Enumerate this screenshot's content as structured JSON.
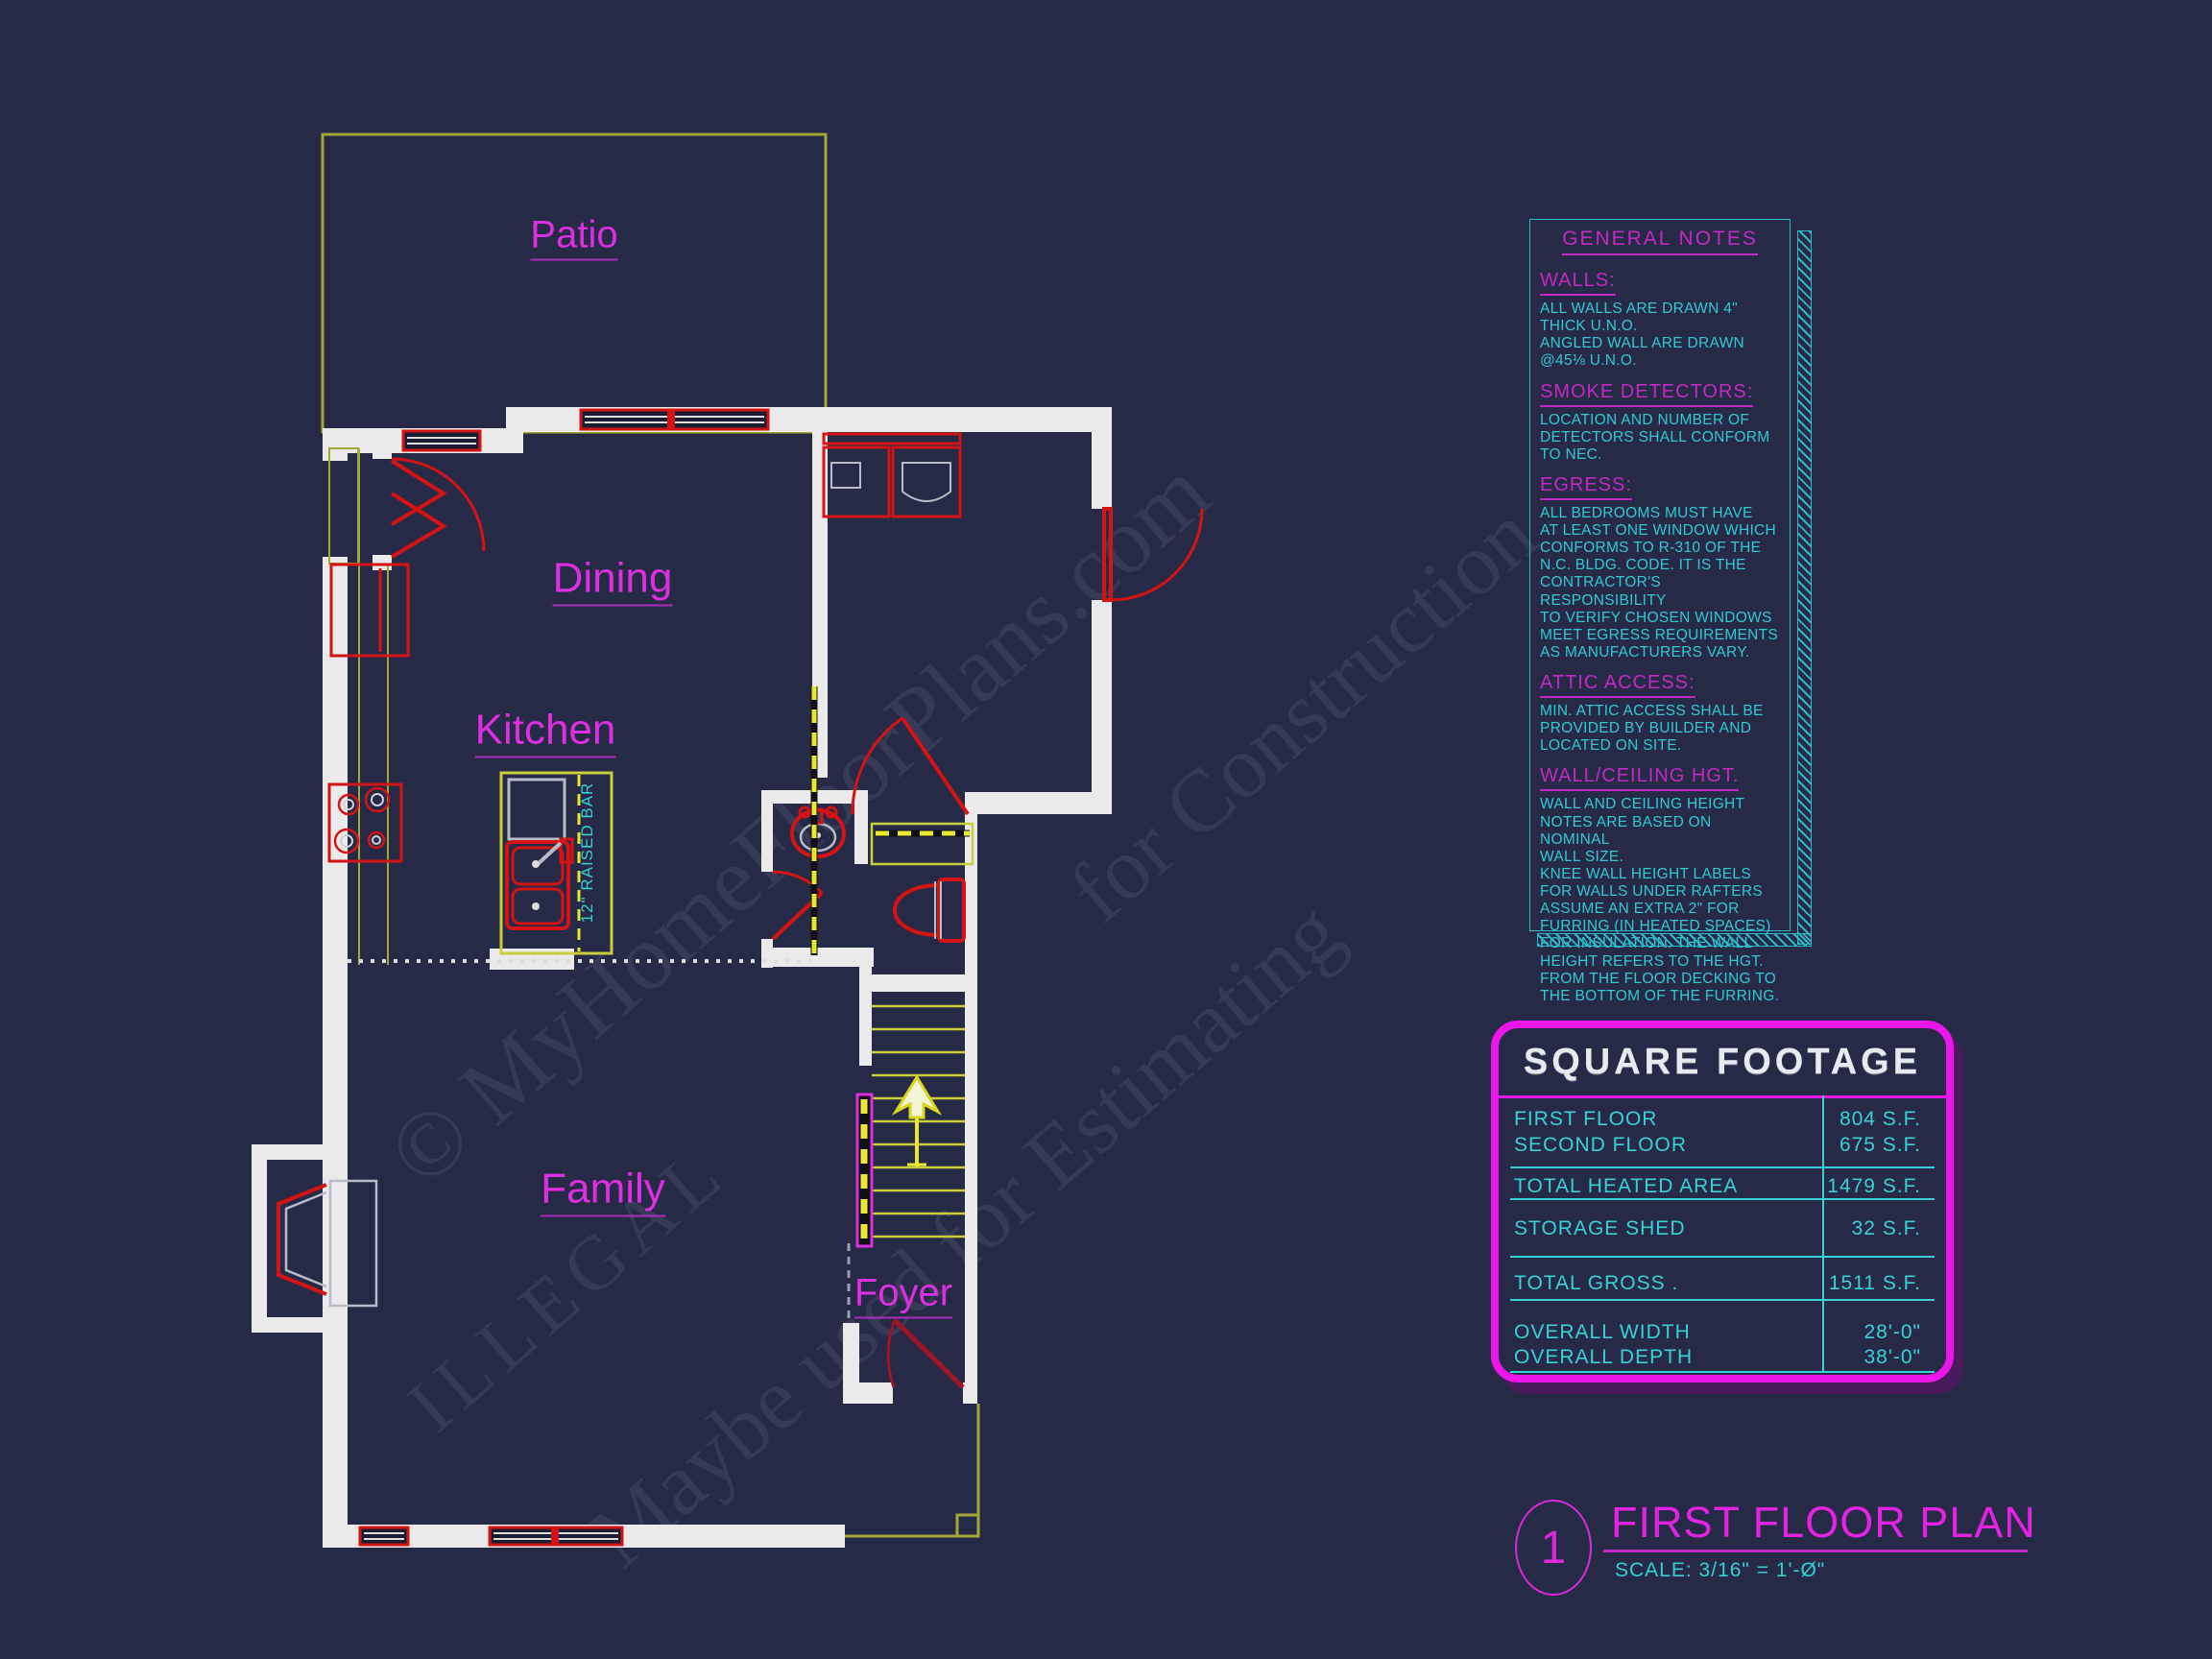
{
  "colors": {
    "background": "#262a46",
    "wall_white": "#eaeaea",
    "cad_red": "#d41414",
    "cad_olive": "#a4a837",
    "bright_yellow": "#e8e833",
    "tread_yellow": "#c9cf3a",
    "magenta": "#e224e2",
    "cyan": "#35cfd4"
  },
  "watermark": {
    "lines": [
      "© MyHomeFloorPlans.com",
      "ILLEGAL",
      "Maybe used for Estimating",
      "for Construction"
    ]
  },
  "plan": {
    "rooms": [
      {
        "name": "Patio"
      },
      {
        "name": "Dining"
      },
      {
        "name": "Kitchen"
      },
      {
        "name": "Family"
      },
      {
        "name": "Foyer"
      }
    ],
    "raised_bar_label": "12\" RAISED BAR"
  },
  "notes": {
    "title": "GENERAL NOTES",
    "sections": [
      {
        "heading": "WALLS:",
        "body": "ALL WALLS ARE DRAWN 4\"\nTHICK U.N.O.\nANGLED WALL ARE DRAWN\n@45⅛ U.N.O."
      },
      {
        "heading": "SMOKE DETECTORS:",
        "body": "LOCATION AND NUMBER OF\nDETECTORS SHALL CONFORM\nTO NEC."
      },
      {
        "heading": "EGRESS:",
        "body": "ALL BEDROOMS MUST HAVE\nAT LEAST ONE WINDOW WHICH\nCONFORMS TO R-310 OF THE\nN.C. BLDG. CODE. IT IS THE\nCONTRACTOR'S RESPONSIBILITY\nTO VERIFY CHOSEN WINDOWS\nMEET EGRESS REQUIREMENTS\nAS MANUFACTURERS VARY."
      },
      {
        "heading": "ATTIC ACCESS:",
        "body": "MIN. ATTIC ACCESS SHALL BE\nPROVIDED BY BUILDER AND\nLOCATED ON SITE."
      },
      {
        "heading": "WALL/CEILING HGT.",
        "body": "WALL AND CEILING HEIGHT\nNOTES ARE BASED ON NOMINAL\nWALL SIZE.\nKNEE WALL HEIGHT LABELS\nFOR WALLS UNDER RAFTERS\nASSUME AN EXTRA 2\" FOR\nFURRING (IN HEATED SPACES)\nFOR INSULATION. THE WALL\nHEIGHT REFERS TO THE HGT.\nFROM THE FLOOR DECKING TO\nTHE BOTTOM OF THE FURRING."
      }
    ]
  },
  "square_footage": {
    "title": "SQUARE FOOTAGE",
    "rows": [
      {
        "label": "FIRST FLOOR",
        "value": "804 S.F."
      },
      {
        "label": "SECOND FLOOR",
        "value": "675 S.F."
      },
      {
        "label": "TOTAL HEATED AREA",
        "value": "1479 S.F."
      },
      {
        "label": "STORAGE SHED",
        "value": "32 S.F."
      },
      {
        "label": "TOTAL GROSS .",
        "value": "1511 S.F."
      },
      {
        "label": "OVERALL WIDTH",
        "value": "28'-0\""
      },
      {
        "label": "OVERALL DEPTH",
        "value": "38'-0\""
      }
    ]
  },
  "title_block": {
    "sheet_number": "1",
    "title": "FIRST FLOOR PLAN",
    "scale": "SCALE: 3/16\" = 1'-Ø\""
  }
}
